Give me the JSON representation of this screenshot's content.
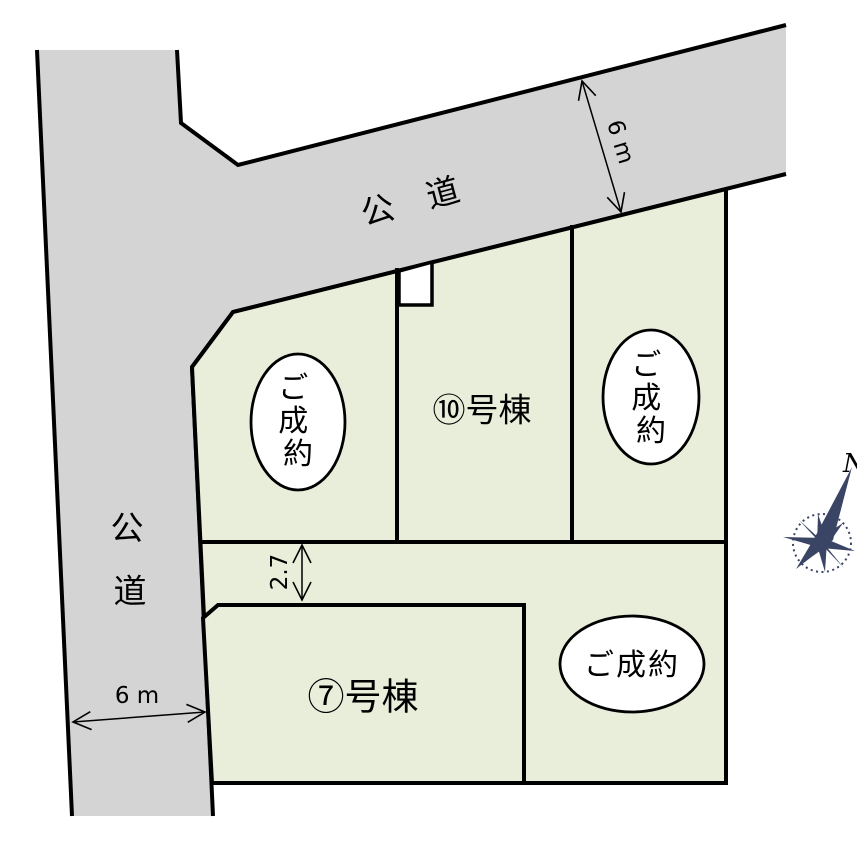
{
  "diagram": {
    "roads": {
      "top": {
        "name_label": "公 道",
        "width_label": "6 m"
      },
      "left": {
        "name_label_chars": [
          "公",
          "道"
        ],
        "width_label": "6 m"
      }
    },
    "setback": {
      "width_label": "2.7"
    },
    "lots": {
      "lot_10": {
        "label": "⑩号棟"
      },
      "lot_7": {
        "label": "⑦号棟"
      },
      "sold_label": "ご成約",
      "sold_label_chars": [
        "ご",
        "成",
        "約"
      ]
    },
    "compass": {
      "north_label": "N"
    },
    "colors": {
      "road_fill": "#d4d4d4",
      "lot_fill": "#e9eedb",
      "outline": "#000000",
      "badge_fill": "#ffffff",
      "compass": "#3a4565"
    }
  }
}
